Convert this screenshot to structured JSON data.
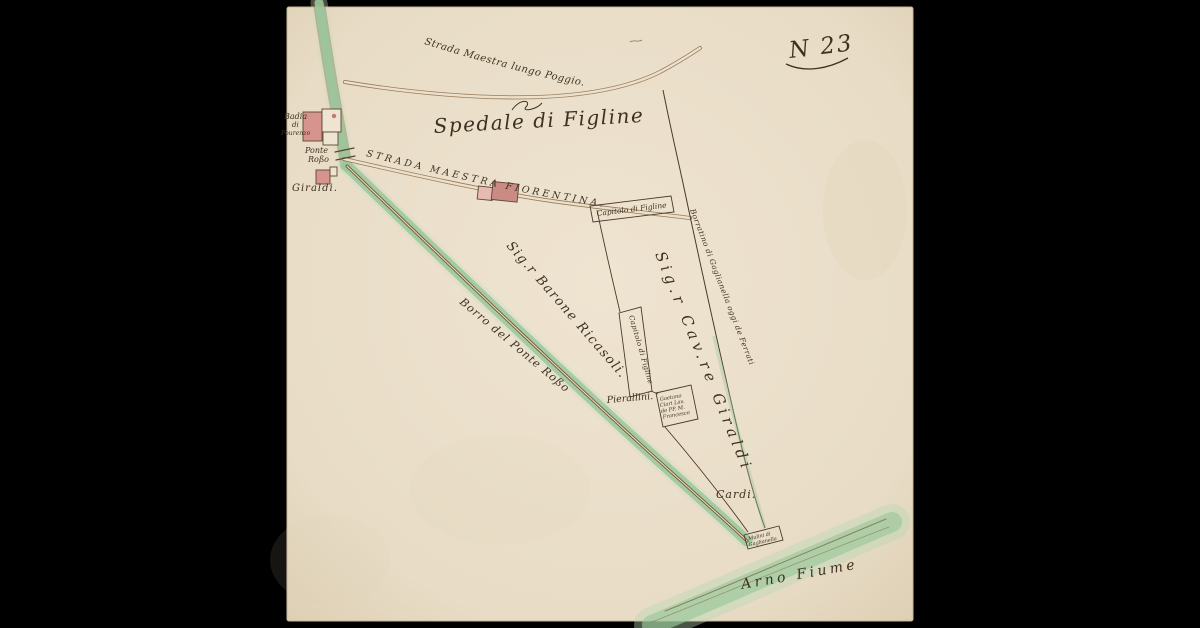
{
  "sheet": {
    "number": "N 23",
    "type": "hand-drawn estate map, ink and watercolor on aged paper"
  },
  "colors": {
    "background": "#000000",
    "paper": "#e9dec9",
    "paper_edge": "#d8c8ab",
    "ink": "#3f3122",
    "road_brown": "#8a6847",
    "stream_green": "#9ac79b",
    "building_pink": "#d7948e",
    "building_light": "#efe4d2"
  },
  "labels": {
    "sheet_number": "N 23",
    "strada_poggio": "Strada Maestra lungo Poggio.",
    "spedale": "Spedale di Figline",
    "badia": {
      "lines": [
        "Badia",
        "di",
        "Fourenzo"
      ]
    },
    "ponte_rosso": {
      "lines": [
        "Ponte",
        "Roßo"
      ]
    },
    "giraldi_house": "Giraldi.",
    "strada_fiorentina": "STRADA MAESTRA FIORENTINA.",
    "capitolo_top": "Capitolo di Figline",
    "gaglianella_boundary": "Borratino di Gaglianella oggi de Ferrati",
    "barone_ricasoli": "Sig.r Barone Ricasoli.",
    "cav_giraldi": "Sig.r Cav.re Giraldi",
    "borro": "Borro del Ponte Roßo",
    "capitolo_strip": "Capitolo di Figline",
    "pierallini": "Pierallini.",
    "gaetano_box": {
      "lines": [
        "Gaetano",
        "Ciari Lav.",
        "de PP. M.",
        "Francesco"
      ]
    },
    "cardi": "Cardi.",
    "mulini_box": {
      "lines": [
        "Mulini di",
        "Gaglianella"
      ]
    },
    "arno": "Arno Fiume"
  }
}
